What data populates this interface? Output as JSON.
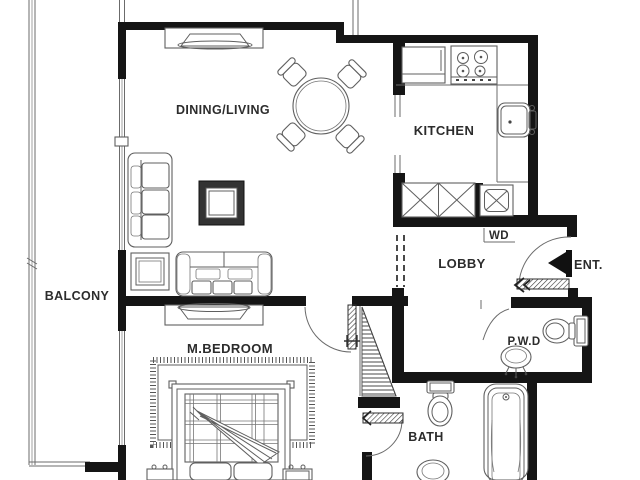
{
  "rooms": {
    "dining_living": "DINING/LIVING",
    "kitchen": "KITCHEN",
    "balcony": "BALCONY",
    "lobby": "LOBBY",
    "master_bedroom": "M.BEDROOM",
    "bath": "BATH",
    "powder_room": "P.W.D",
    "entrance": "ENT.",
    "washer_dryer": "WD"
  },
  "colors": {
    "wall": "#151515",
    "line": "#5f5f5f",
    "text": "#2c2c2c",
    "background": "#ffffff"
  }
}
